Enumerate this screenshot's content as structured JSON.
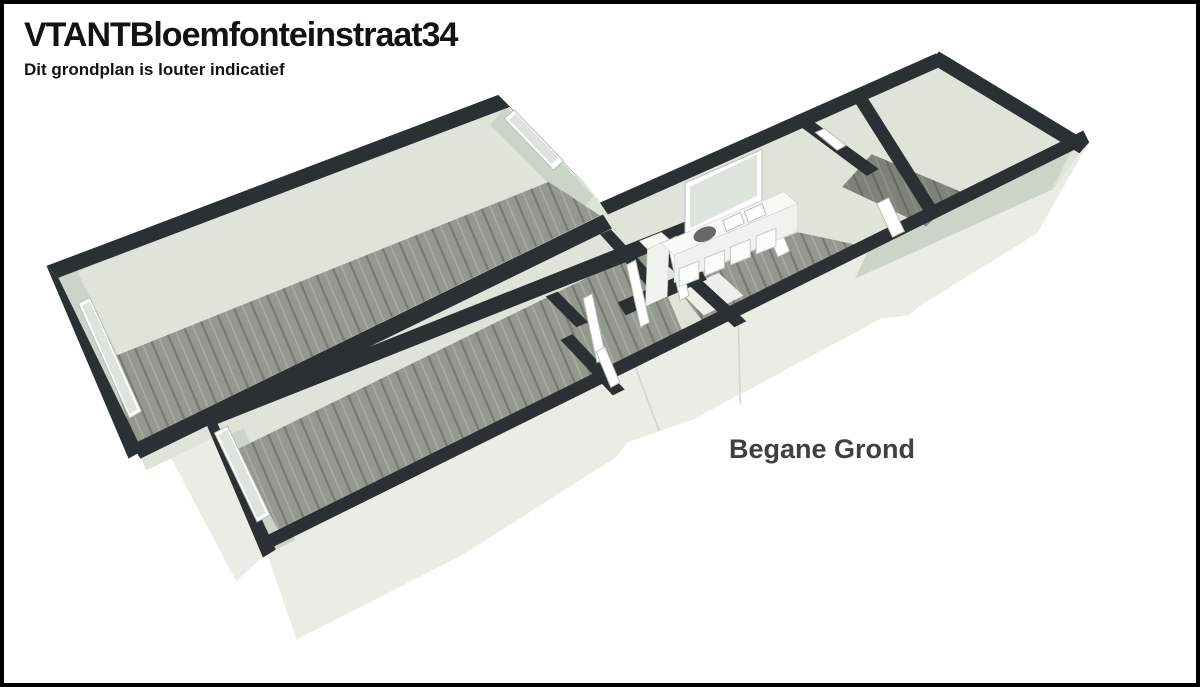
{
  "header": {
    "title": "VTANTBloemfonteinstraat34",
    "subtitle": "Dit grondplan is louter indicatief"
  },
  "plan": {
    "floor_label": "Begane Grond",
    "type": "3d-floorplan",
    "features": [
      "living-room-left",
      "living-room-front",
      "hallway",
      "bathroom",
      "kitchen-with-counter-sink-and-window",
      "rear-room",
      "right-end-room",
      "windows-in-end-walls"
    ]
  },
  "colors": {
    "background": "#ffffff",
    "border": "#000000",
    "title_text": "#131313",
    "label_text": "#3c4142",
    "wall_top": "#2b3132",
    "wall_exterior": "#e9ede5",
    "wall_interior": "#dfe4db",
    "wall_shaded": "#ccd4ca",
    "floor_wood": "#939890",
    "floor_dark": "#7d827b",
    "bath_floor": "#edf0ea",
    "counter": "#f7f9f5",
    "counter_front": "#eff3ed",
    "window_glass": "#dce4dc",
    "sink": "#646b64"
  }
}
